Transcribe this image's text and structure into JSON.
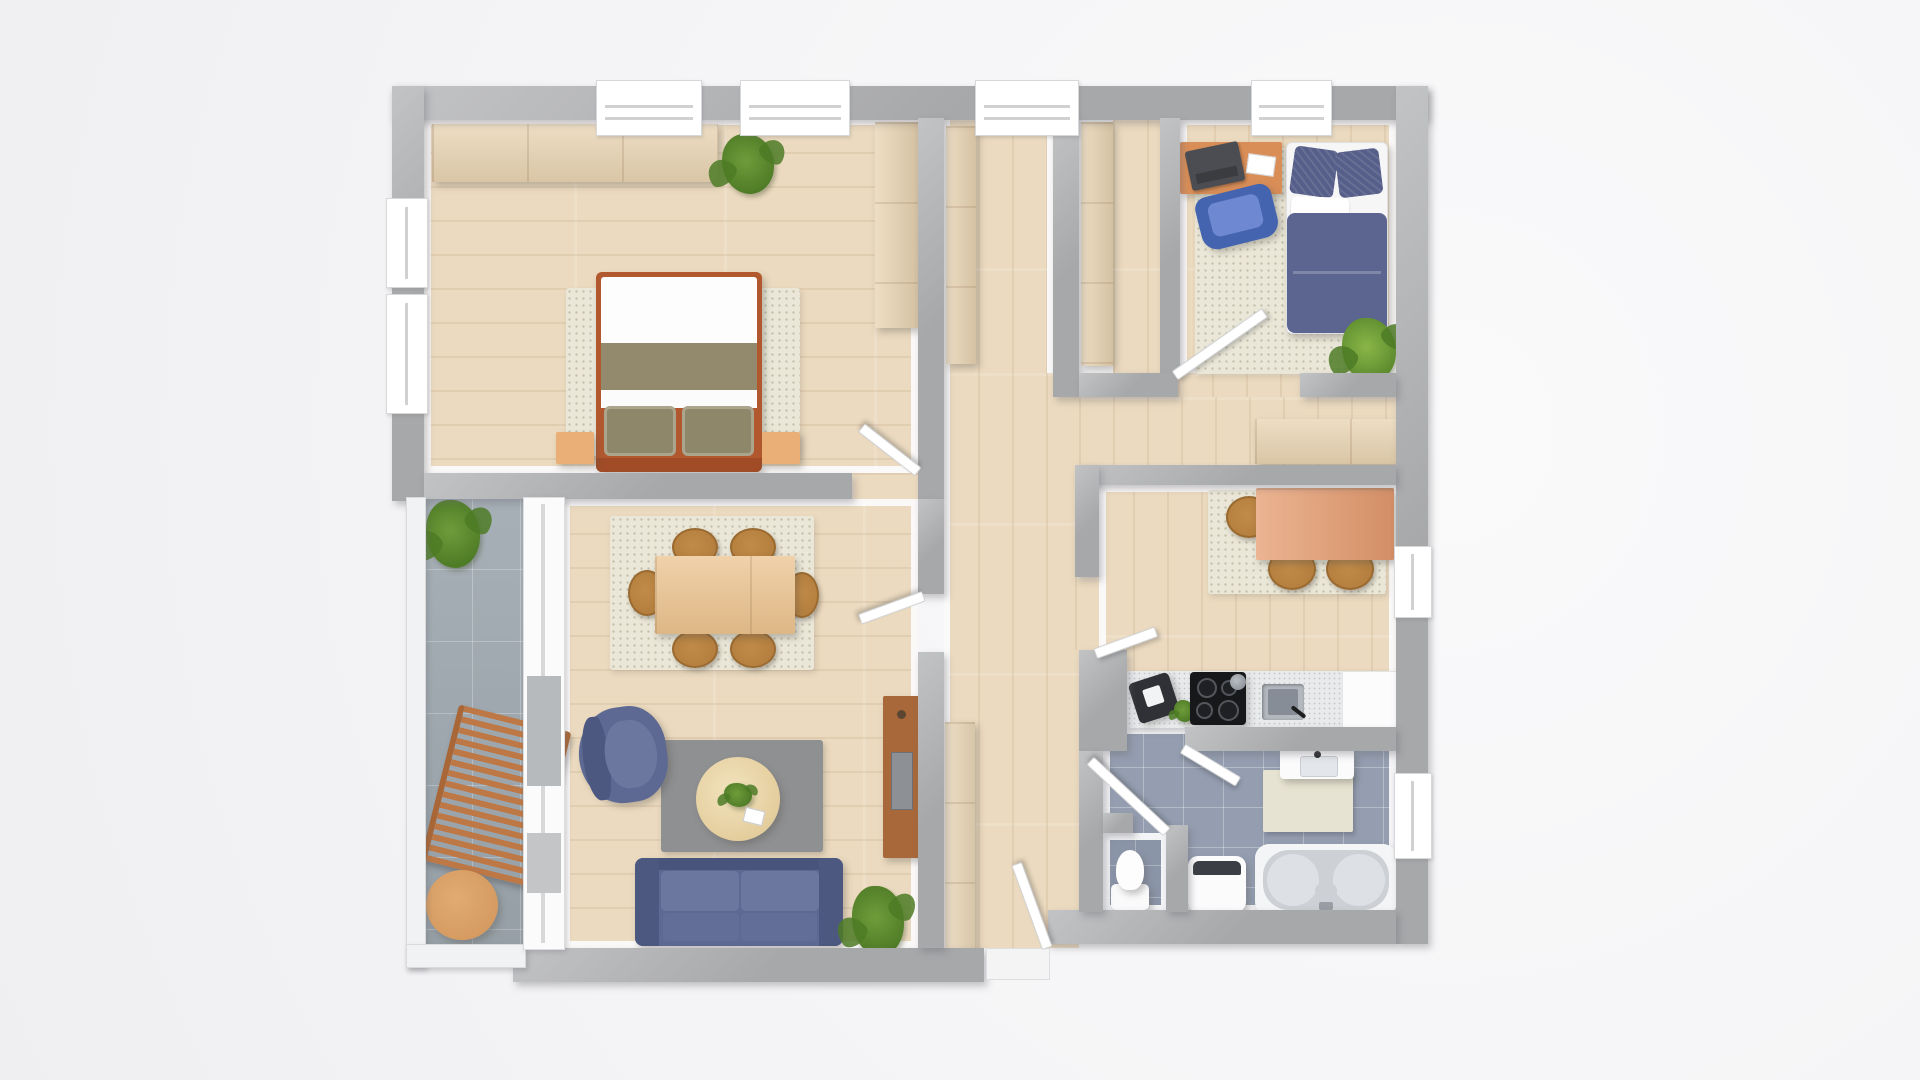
{
  "description": "Top-down 3D rendered apartment floor plan, no visible text labels",
  "colors": {
    "wall": "#a7a8aa",
    "wallLight": "#c2c3c5",
    "floor": "#ebdabf",
    "balconyTile": "#9fa9b0",
    "bathTile": "#949eb0",
    "wcTile": "#8b95a8",
    "rugBeige": "#eae7d8",
    "rugGray": "#8f9092",
    "counter": "#e9eaec",
    "navy": "#5d6992",
    "navyDark": "#4d5880",
    "navyLight": "#6b779f",
    "navyPillow": "#565f89",
    "chairBlue": "#4564b0",
    "chairBlueSeat": "#6e89d2",
    "chairWood": "#b5803f",
    "woodLight": "#e7d2b0",
    "woodMid": "#ebc28e",
    "woodOrange": "#d98e58",
    "woodSalmon": "#e59b6e",
    "woodDark": "#a8683a",
    "woodTan": "#d59a60",
    "nightstand": "#eaaf76",
    "bedFrame": "#b2582f",
    "olive": "#938a6d",
    "olivePillow": "#8f8769",
    "green": "#6f9c3a",
    "greenDark": "#4e7b26",
    "doorWhite": "#ffffff"
  },
  "rooms": [
    {
      "name": "bedroom-main",
      "items": [
        "wardrobe",
        "plant",
        "tall wardrobe",
        "double bed",
        "rug",
        "nightstand",
        "nightstand"
      ]
    },
    {
      "name": "bedroom-kids",
      "items": [
        "desk",
        "laptop",
        "office chair",
        "single bed",
        "rug",
        "plant",
        "wardrobe"
      ]
    },
    {
      "name": "hallway",
      "items": [
        "built-in wardrobe",
        "closet wardrobe",
        "shelf",
        "sideboard",
        "entrance door"
      ]
    },
    {
      "name": "living-dining-room",
      "items": [
        "dining table",
        "dining chair",
        "dining rug",
        "tv board",
        "armchair",
        "coffee table",
        "living rug",
        "sofa",
        "plant"
      ]
    },
    {
      "name": "kitchen",
      "items": [
        "kitchen table",
        "chair",
        "rug",
        "countertop",
        "coffee machine",
        "stove",
        "sink",
        "worktop"
      ]
    },
    {
      "name": "bathroom",
      "items": [
        "washbasin",
        "bath mat",
        "bathtub",
        "washing machine"
      ]
    },
    {
      "name": "wc",
      "items": [
        "toilet"
      ]
    },
    {
      "name": "balcony",
      "items": [
        "plant",
        "sun lounger",
        "side table"
      ]
    }
  ]
}
